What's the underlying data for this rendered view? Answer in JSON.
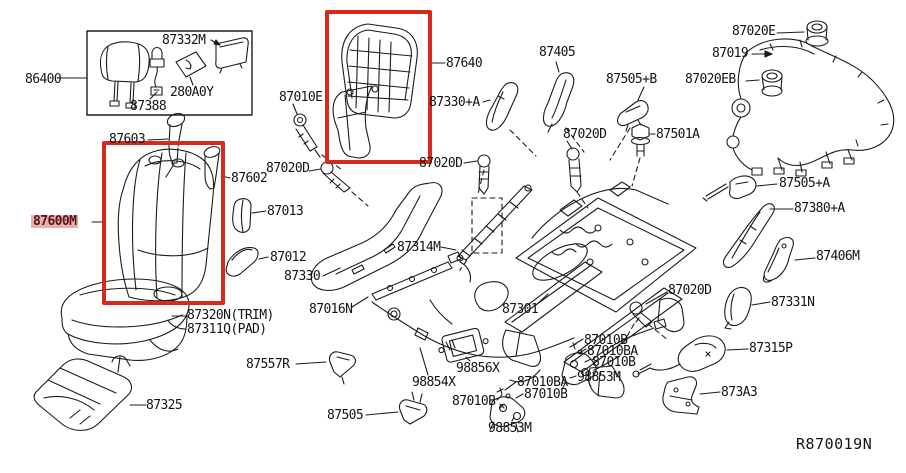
{
  "diagram": {
    "ref": "R870019N",
    "type": "exploded-parts-diagram",
    "subject": "front seat assembly",
    "highlighted_part": "87600M",
    "colors": {
      "line": "#1c1c1c",
      "callout_red": "#d52a1e",
      "highlight_bg": "#e9aeae",
      "highlight_text": "#5a1414",
      "background": "#ffffff"
    }
  },
  "parts": {
    "p86400": "86400",
    "p87332M": "87332M",
    "p87388": "87388",
    "p280A0Y": "280A0Y",
    "p87603": "87603",
    "p87602": "87602",
    "p87600M": "87600M",
    "p87013": "87013",
    "p87012": "87012",
    "p87330": "87330",
    "p87320N": "87320N(TRIM)",
    "p87311Q": "87311Q(PAD)",
    "p87325": "87325",
    "p87557R": "87557R",
    "p87505": "87505",
    "p87016N": "87016N",
    "p98854X": "98854X",
    "p98856X": "98856X",
    "p87010B": "87010B",
    "p87010BA": "87010BA",
    "p98853M": "98853M",
    "p87010E": "87010E",
    "p87640": "87640",
    "p87330A": "87330+A",
    "p87405": "87405",
    "p87505B": "87505+B",
    "p87020D": "87020D",
    "p87501A": "87501A",
    "p87020E": "87020E",
    "p87019": "87019",
    "p87020EB": "87020EB",
    "p87505A": "87505+A",
    "p87380A": "87380+A",
    "p87406M": "87406M",
    "p87331N": "87331N",
    "p87315P": "87315P",
    "p873A3": "873A3",
    "p87301": "87301",
    "p87314M": "87314M"
  }
}
